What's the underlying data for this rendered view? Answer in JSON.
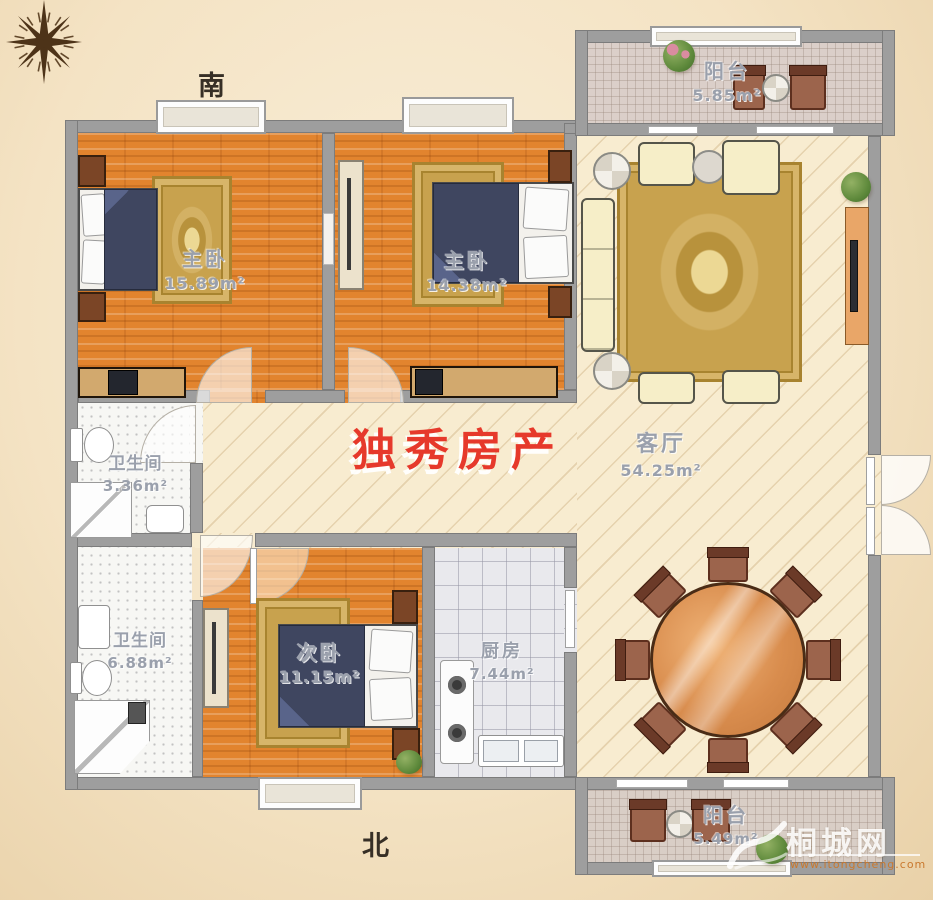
{
  "compass": {
    "south_label": "南",
    "north_label": "北"
  },
  "rooms": {
    "master1": {
      "name": "主卧",
      "area": "15.89m²"
    },
    "master2": {
      "name": "主卧",
      "area": "14.38m²"
    },
    "living": {
      "name": "客厅",
      "area": "54.25m²"
    },
    "bath1": {
      "name": "卫生间",
      "area": "3.36m²"
    },
    "bath2": {
      "name": "卫生间",
      "area": "6.88m²"
    },
    "bed3": {
      "name": "次卧",
      "area": "11.15m²"
    },
    "kitchen": {
      "name": "厨房",
      "area": "7.44m²"
    },
    "balcony_top": {
      "name": "阳台",
      "area": "5.85m²"
    },
    "balcony_bottom": {
      "name": "阳台",
      "area": "5.49m²"
    }
  },
  "watermarks": {
    "agency": "独秀房产",
    "site_name": "桐城网",
    "site_url": "www.itongcheng.com"
  },
  "palette": {
    "paper": "#f4e3c4",
    "wall": "#9e9e9e",
    "wood_floor": "#e2842e",
    "living_floor": "#f8ecd0",
    "rug_gold": "#c8a24e",
    "bed_cover": "#3f4660",
    "agency_red": "#e6392b"
  }
}
